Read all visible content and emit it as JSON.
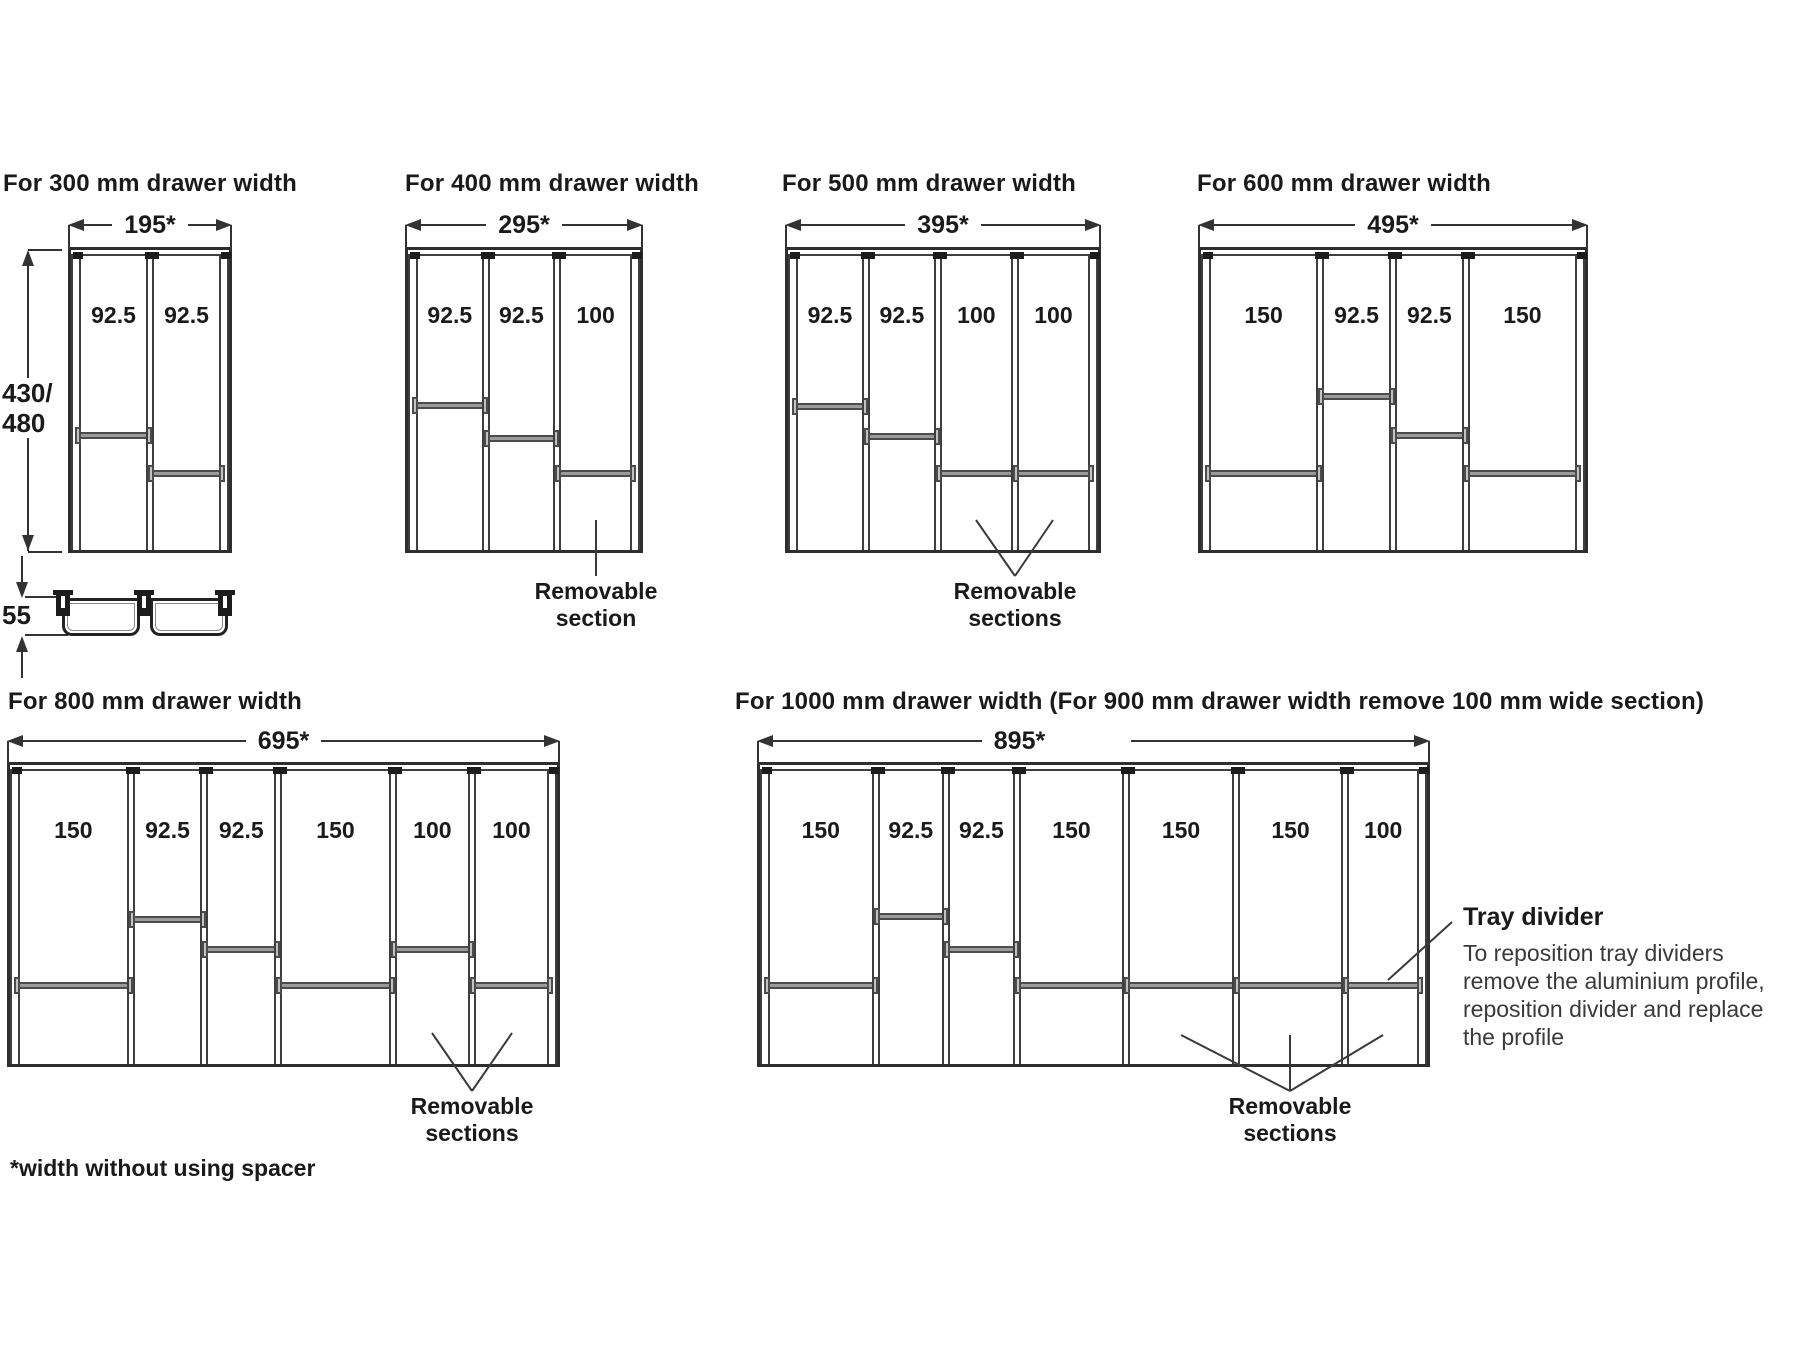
{
  "title_note": "*width without using spacer",
  "depth_dimension": {
    "line1": "430/",
    "line2": "480"
  },
  "tray_height_label": "55",
  "colors": {
    "line": "#3a3a3a",
    "divider_bar": "#9a9a9a",
    "text": "#1a1a1a"
  },
  "tray_divider_note": {
    "title": "Tray divider",
    "body_lines": [
      "To reposition tray dividers",
      "remove the aluminium profile,",
      "reposition divider and replace",
      "the profile"
    ],
    "leader": [
      1452,
      922,
      1388,
      980
    ]
  },
  "drawers": [
    {
      "id": "300",
      "header": "For 300 mm drawer width",
      "header_pos": [
        3,
        170
      ],
      "dim_label": "195*",
      "dim_label_dx": 0,
      "dim_y": 212,
      "box": [
        68,
        247,
        164,
        306
      ],
      "sections": [
        {
          "label": "92.5",
          "mm": 92.5,
          "bar_y": 185
        },
        {
          "label": "92.5",
          "mm": 92.5,
          "bar_y": 223
        }
      ],
      "annotation": null
    },
    {
      "id": "400",
      "header": "For 400 mm drawer width",
      "header_pos": [
        405,
        170
      ],
      "dim_label": "295*",
      "dim_label_dx": 0,
      "dim_y": 212,
      "box": [
        405,
        247,
        238,
        306
      ],
      "sections": [
        {
          "label": "92.5",
          "mm": 92.5,
          "bar_y": 155
        },
        {
          "label": "92.5",
          "mm": 92.5,
          "bar_y": 188
        },
        {
          "label": "100",
          "mm": 100,
          "bar_y": 223
        }
      ],
      "annotation": {
        "lines": [
          "Removable",
          "section"
        ],
        "cx": 596,
        "top": 578,
        "leaders": [
          [
            596,
            576,
            596,
            520
          ]
        ]
      }
    },
    {
      "id": "500",
      "header": "For 500 mm drawer width",
      "header_pos": [
        782,
        170
      ],
      "dim_label": "395*",
      "dim_label_dx": 0,
      "dim_y": 212,
      "box": [
        785,
        247,
        316,
        306
      ],
      "sections": [
        {
          "label": "92.5",
          "mm": 92.5,
          "bar_y": 156
        },
        {
          "label": "92.5",
          "mm": 92.5,
          "bar_y": 186
        },
        {
          "label": "100",
          "mm": 100,
          "bar_y": 223
        },
        {
          "label": "100",
          "mm": 100,
          "bar_y": 223
        }
      ],
      "annotation": {
        "lines": [
          "Removable",
          "sections"
        ],
        "cx": 1015,
        "top": 578,
        "leaders": [
          [
            1015,
            576,
            976,
            520
          ],
          [
            1015,
            576,
            1053,
            520
          ]
        ]
      }
    },
    {
      "id": "600",
      "header": "For 600 mm drawer width",
      "header_pos": [
        1197,
        170
      ],
      "dim_label": "495*",
      "dim_label_dx": 0,
      "dim_y": 212,
      "box": [
        1198,
        247,
        390,
        306
      ],
      "sections": [
        {
          "label": "150",
          "mm": 150,
          "bar_y": 223
        },
        {
          "label": "92.5",
          "mm": 92.5,
          "bar_y": 146
        },
        {
          "label": "92.5",
          "mm": 92.5,
          "bar_y": 185
        },
        {
          "label": "150",
          "mm": 150,
          "bar_y": 223
        }
      ],
      "annotation": null
    },
    {
      "id": "800",
      "header": "For 800 mm drawer width",
      "header_pos": [
        8,
        688
      ],
      "dim_label": "695*",
      "dim_label_dx": 0,
      "dim_y": 728,
      "box": [
        7,
        762,
        553,
        305
      ],
      "sections": [
        {
          "label": "150",
          "mm": 150,
          "bar_y": 220
        },
        {
          "label": "92.5",
          "mm": 92.5,
          "bar_y": 154
        },
        {
          "label": "92.5",
          "mm": 92.5,
          "bar_y": 184
        },
        {
          "label": "150",
          "mm": 150,
          "bar_y": 220
        },
        {
          "label": "100",
          "mm": 100,
          "bar_y": 184
        },
        {
          "label": "100",
          "mm": 100,
          "bar_y": 220
        }
      ],
      "annotation": {
        "lines": [
          "Removable",
          "sections"
        ],
        "cx": 472,
        "top": 1093,
        "leaders": [
          [
            472,
            1091,
            432,
            1033
          ],
          [
            472,
            1091,
            512,
            1033
          ]
        ]
      }
    },
    {
      "id": "1000",
      "header": "For 1000 mm drawer width (For 900 mm drawer width remove 100 mm wide section)",
      "header_pos": [
        735,
        688
      ],
      "dim_label": "895*",
      "dim_label_dx": -74,
      "dim_y": 728,
      "box": [
        757,
        762,
        673,
        305
      ],
      "sections": [
        {
          "label": "150",
          "mm": 150,
          "bar_y": 220
        },
        {
          "label": "92.5",
          "mm": 92.5,
          "bar_y": 151
        },
        {
          "label": "92.5",
          "mm": 92.5,
          "bar_y": 184
        },
        {
          "label": "150",
          "mm": 150,
          "bar_y": 220
        },
        {
          "label": "150",
          "mm": 150,
          "bar_y": 220
        },
        {
          "label": "150",
          "mm": 150,
          "bar_y": 220
        },
        {
          "label": "100",
          "mm": 100,
          "bar_y": 220
        }
      ],
      "annotation": {
        "lines": [
          "Removable",
          "sections"
        ],
        "cx": 1290,
        "top": 1093,
        "leaders": [
          [
            1290,
            1091,
            1181,
            1035
          ],
          [
            1290,
            1091,
            1290,
            1035
          ],
          [
            1290,
            1091,
            1383,
            1035
          ]
        ]
      }
    }
  ]
}
